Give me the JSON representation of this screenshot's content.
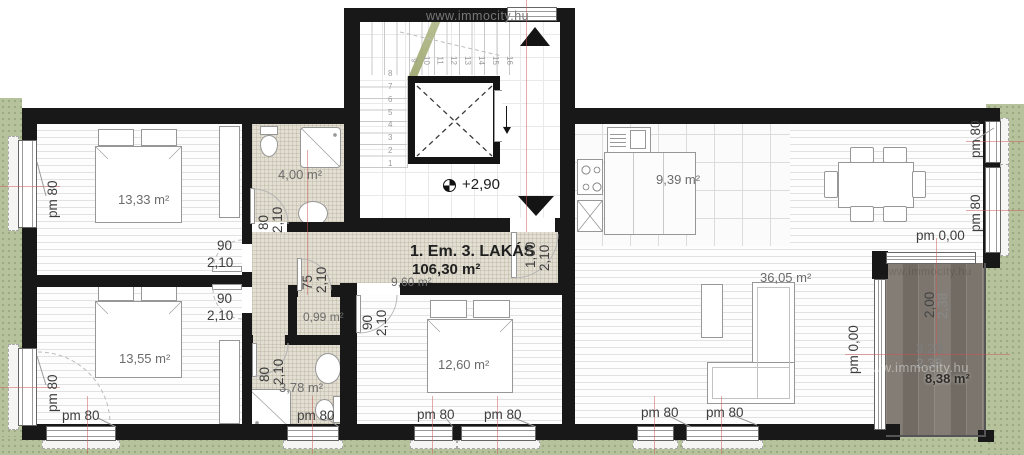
{
  "watermark": "www.immocity.hu",
  "header": {
    "title": "1. Em. 3. LAKÁS",
    "total_area": "106,30 m²"
  },
  "rooms": {
    "bedroom1": "13,33 m²",
    "bath1": "4,00 m²",
    "hall": "9,60 m²",
    "bedroom2": "13,55 m²",
    "wc": "0,99 m²",
    "bath2": "3,78 m²",
    "bedroom3": "12,60 m²",
    "kitchen": "9,39 m²",
    "living": "36,05 m²",
    "terrace": "8,38 m²"
  },
  "levels": {
    "stair": "+2,90",
    "ground": "pm 0,00"
  },
  "windows": {
    "parapet": "pm 80"
  },
  "doors": {
    "w90": "90",
    "w80": "80",
    "w75": "75",
    "w100": "1,00",
    "h210": "2,10"
  },
  "terrace_dims": {
    "w1": "2,00",
    "w2": "2,38",
    "l1": "3,20",
    "l2": "2,38"
  },
  "stairs": {
    "lower": [
      "8",
      "7",
      "6",
      "5",
      "4",
      "3",
      "2",
      "1"
    ],
    "upper": [
      "9",
      "10",
      "11",
      "12",
      "13",
      "14",
      "15",
      "16"
    ]
  },
  "colors": {
    "wall": "#181818",
    "grass": "#b6c29c",
    "deck": "#8a847c",
    "axis": "#cd5555"
  }
}
